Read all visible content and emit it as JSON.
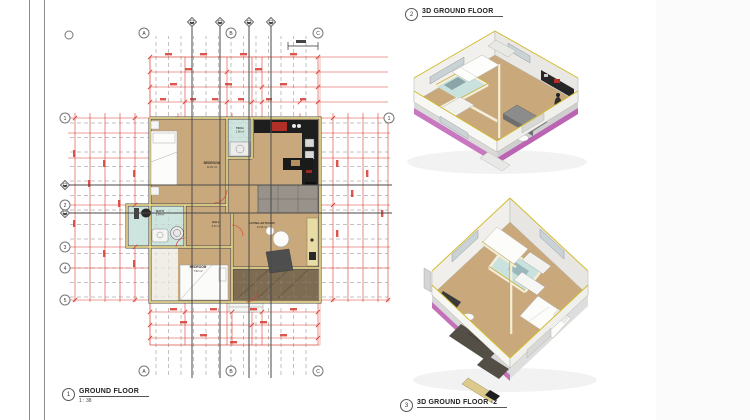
{
  "sheet": {
    "colors": {
      "dimension_red": "#d8392f",
      "wall_yellow": "#e8d88a",
      "floor_tan": "#c9a87c",
      "wet_room_cyan": "#cde4df",
      "terrace_brown": "#7d6b52",
      "plinth_magenta": "#c470b8",
      "section_gray": "#4a4a4a"
    }
  },
  "views": [
    {
      "num": "1",
      "title": "GROUND FLOOR",
      "scale": "1 : 38"
    },
    {
      "num": "2",
      "title": "3D GROUND FLOOR"
    },
    {
      "num": "3",
      "title": "3D GROUND FLOOR -2"
    }
  ],
  "plan": {
    "grid_top": [
      "A",
      "B",
      "C"
    ],
    "grid_bottom": [
      "A",
      "B",
      "C"
    ],
    "grid_left": [
      "1",
      "2",
      "3",
      "4",
      "5"
    ],
    "grid_right": [
      "1"
    ],
    "rooms": [
      {
        "name": "BEDROOM",
        "area": "12.01 m²"
      },
      {
        "name": "TECH.",
        "area": "1.98 m²"
      },
      {
        "name": "BATH",
        "area": "3.94 m²"
      },
      {
        "name": "HALL",
        "area": "2.01 m²"
      },
      {
        "name": "LIVING+KITCHEN",
        "area": "21.35 m²"
      },
      {
        "name": "BEDROOM",
        "area": "7.52 m²"
      }
    ]
  }
}
